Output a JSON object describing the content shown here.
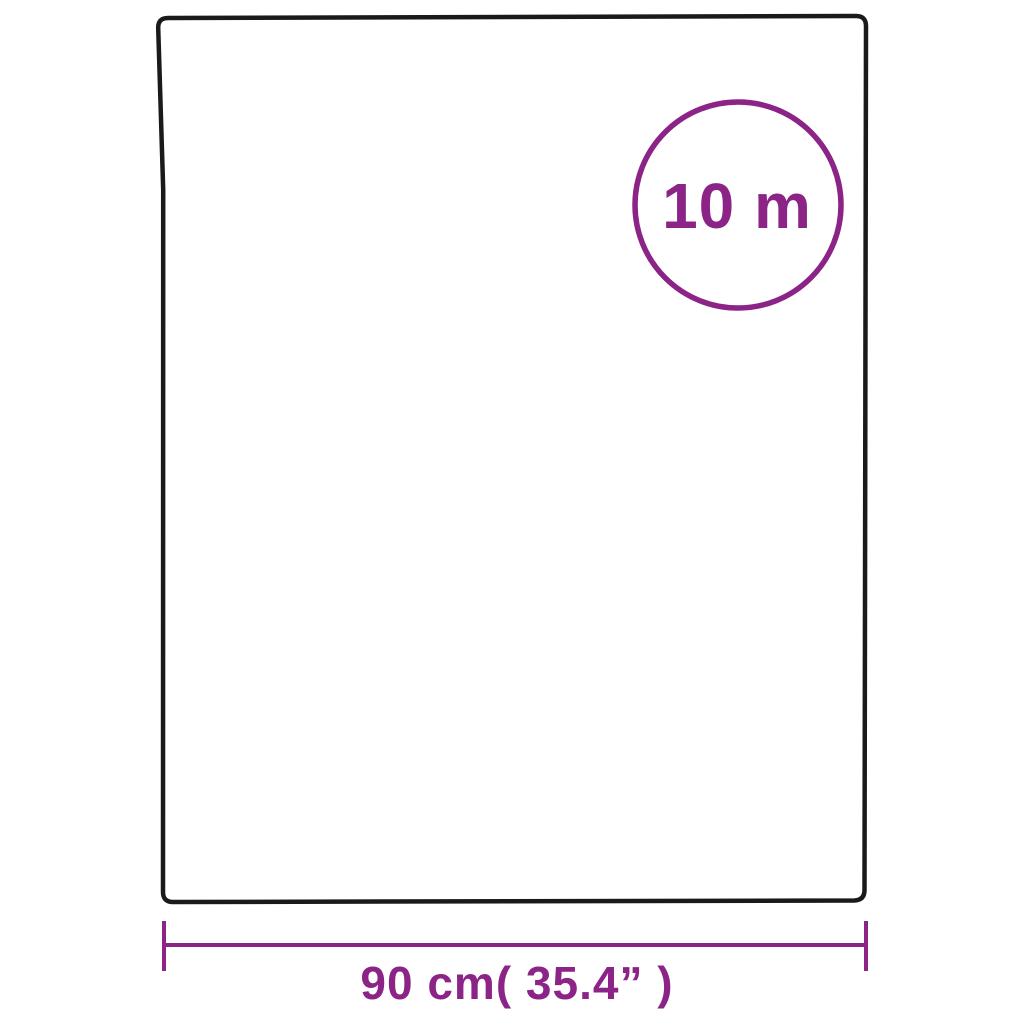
{
  "diagram": {
    "type": "product-dimension-diagram",
    "length_badge": {
      "label": "10 m"
    },
    "width_dimension": {
      "label": "90 cm( 35.4”  )"
    },
    "colors": {
      "accent_purple": "#8C2488",
      "outline_black": "#1A1A1A",
      "background": "#FFFFFF"
    }
  }
}
